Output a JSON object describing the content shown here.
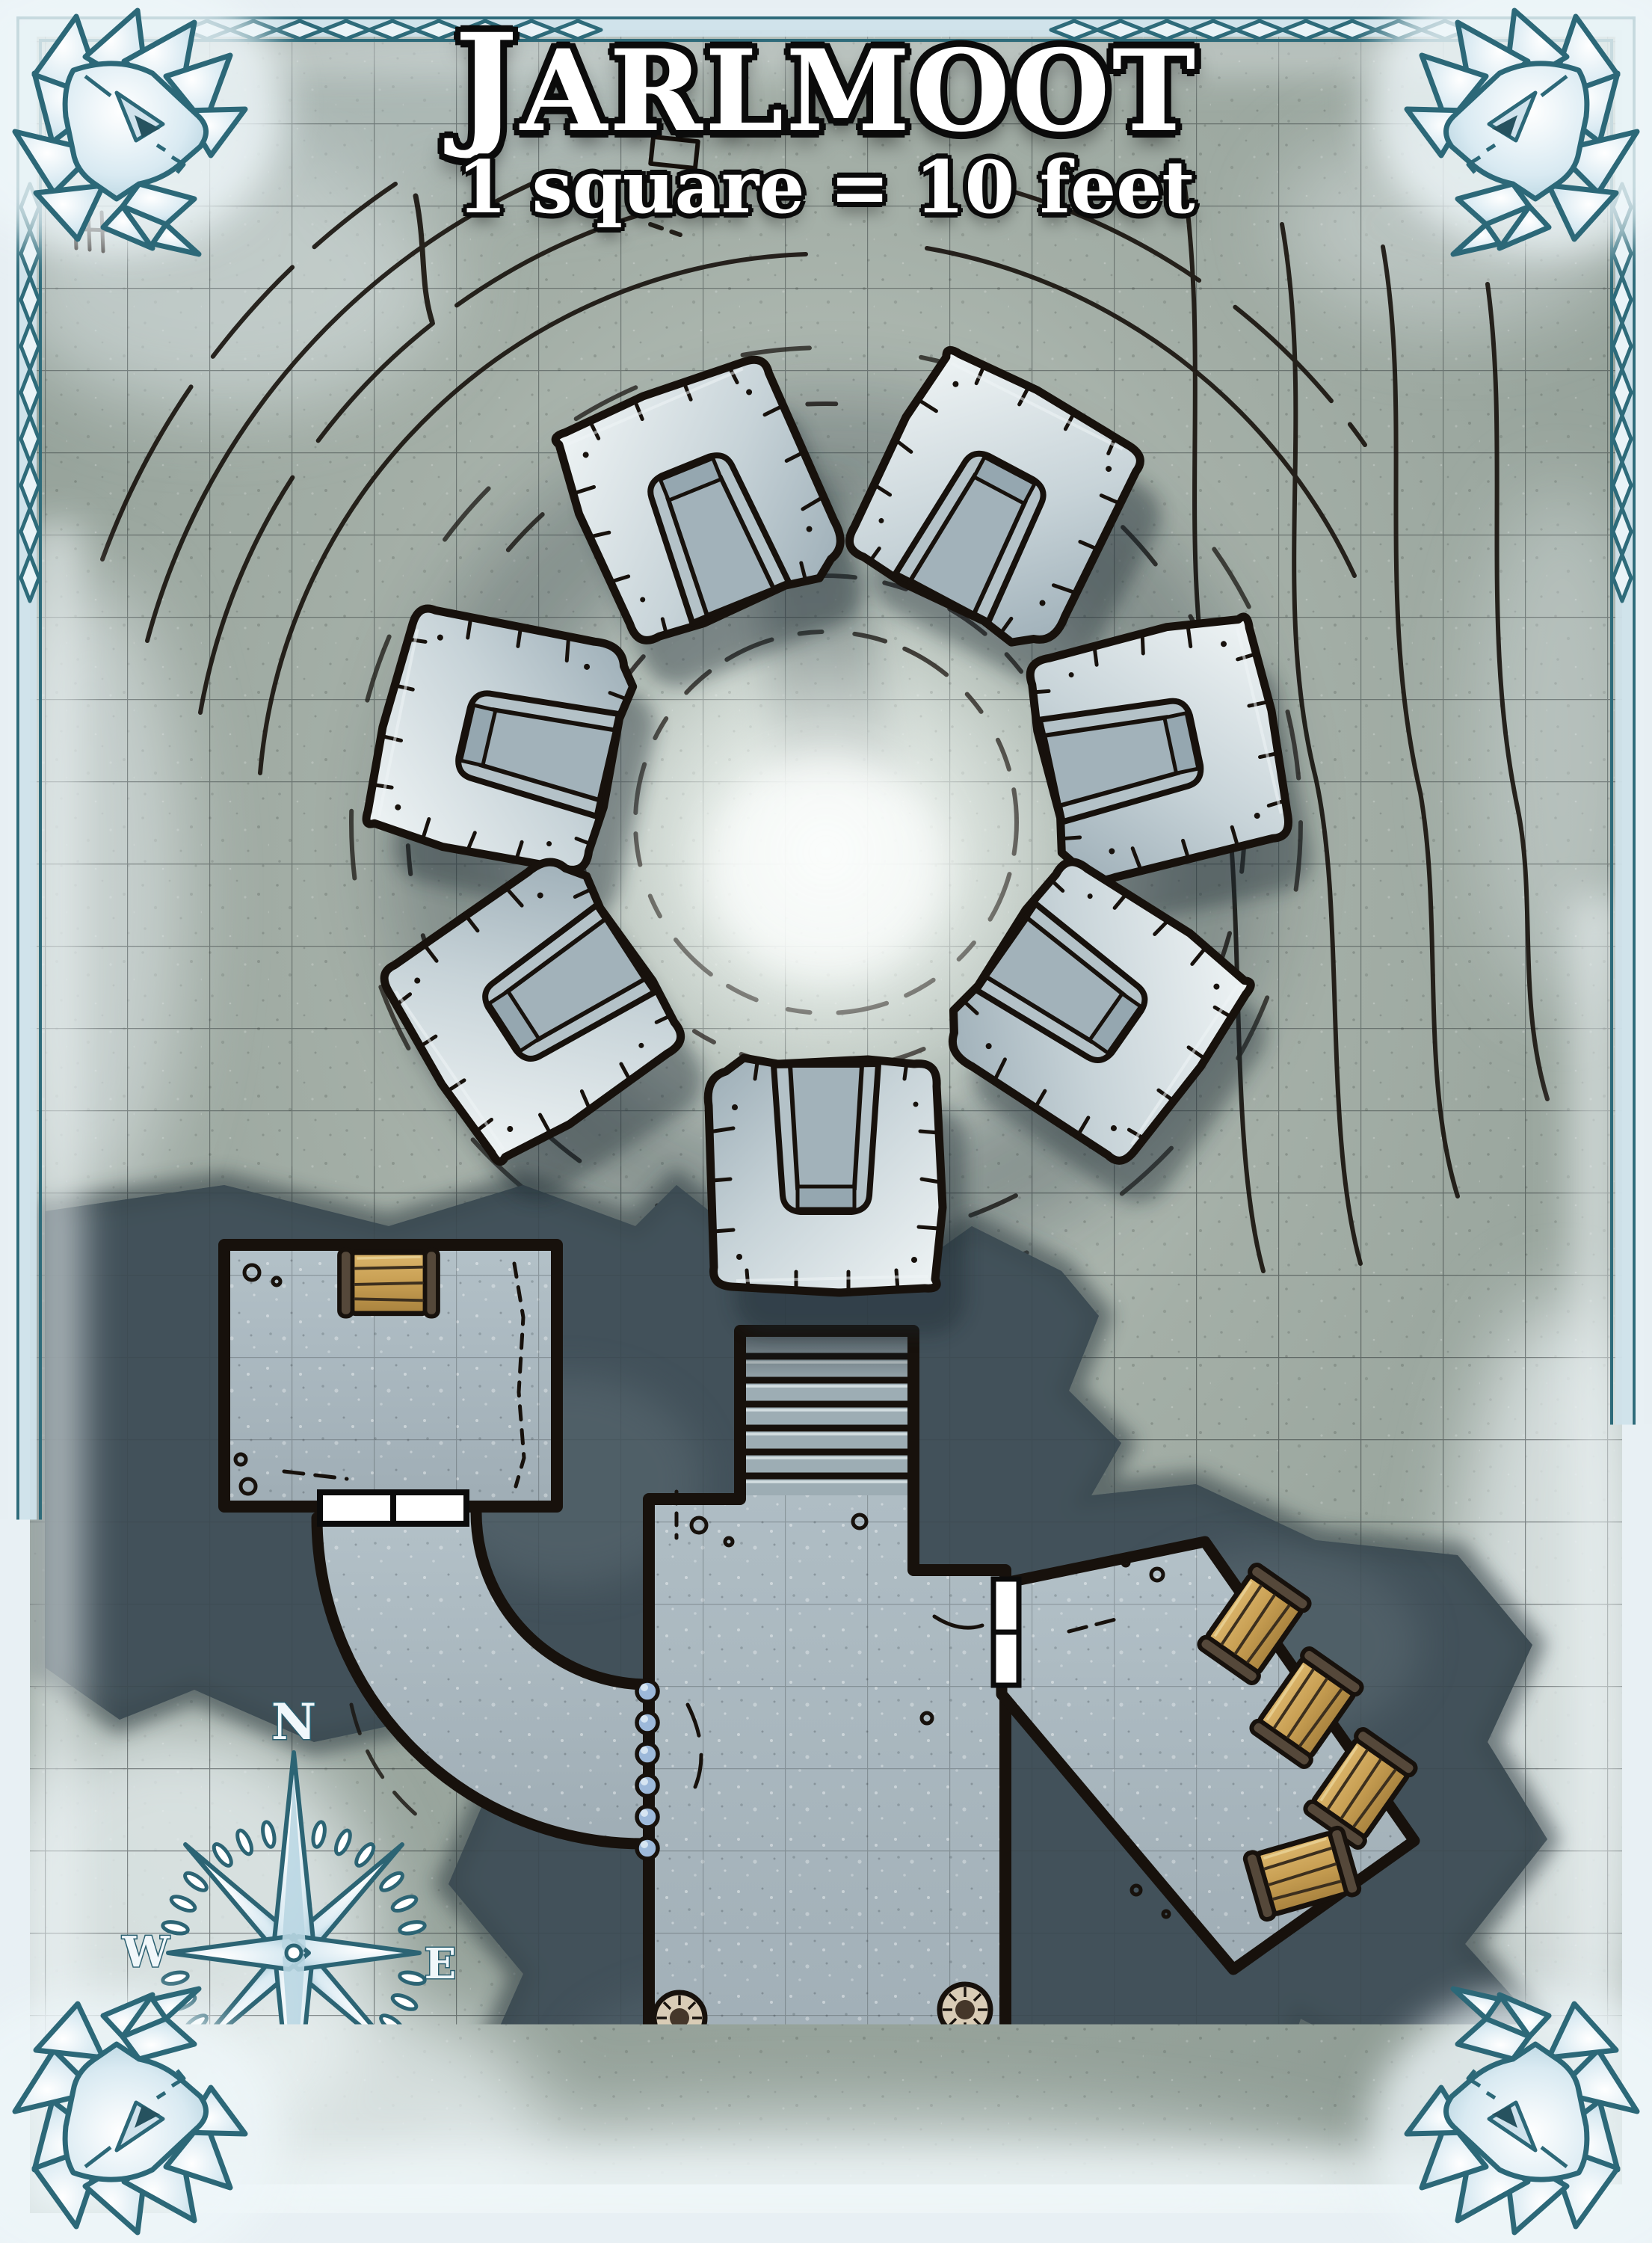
{
  "map": {
    "title": "JARLMOOT",
    "scale_note": "1 square = 10 feet"
  },
  "compass": {
    "north": "N",
    "east": "E",
    "south": "S",
    "west": "W"
  },
  "features": {
    "stone_throne_count": 7,
    "pillar_count": 6,
    "storeroom_barrel_count": 1,
    "east_wing_crate_count": 4,
    "stair_step_count": 7,
    "door_count": 2,
    "wall_stud_count": 6
  },
  "palette": {
    "ink": "#17110c",
    "ground": "#97a29a",
    "ground_bright": "#e9efec",
    "snow": "#edf3f5",
    "bedrock": "#42525a",
    "room_floor": "#a9b7be",
    "wood": "#c79e52",
    "wood_dark": "#55483a",
    "throne_stone": "#cdd8dd",
    "ice_outline": "#2e6b7a",
    "ice_fill": "#ddecf3",
    "stud_blue": "#9db9da",
    "pillar": "#d9ccb6"
  }
}
